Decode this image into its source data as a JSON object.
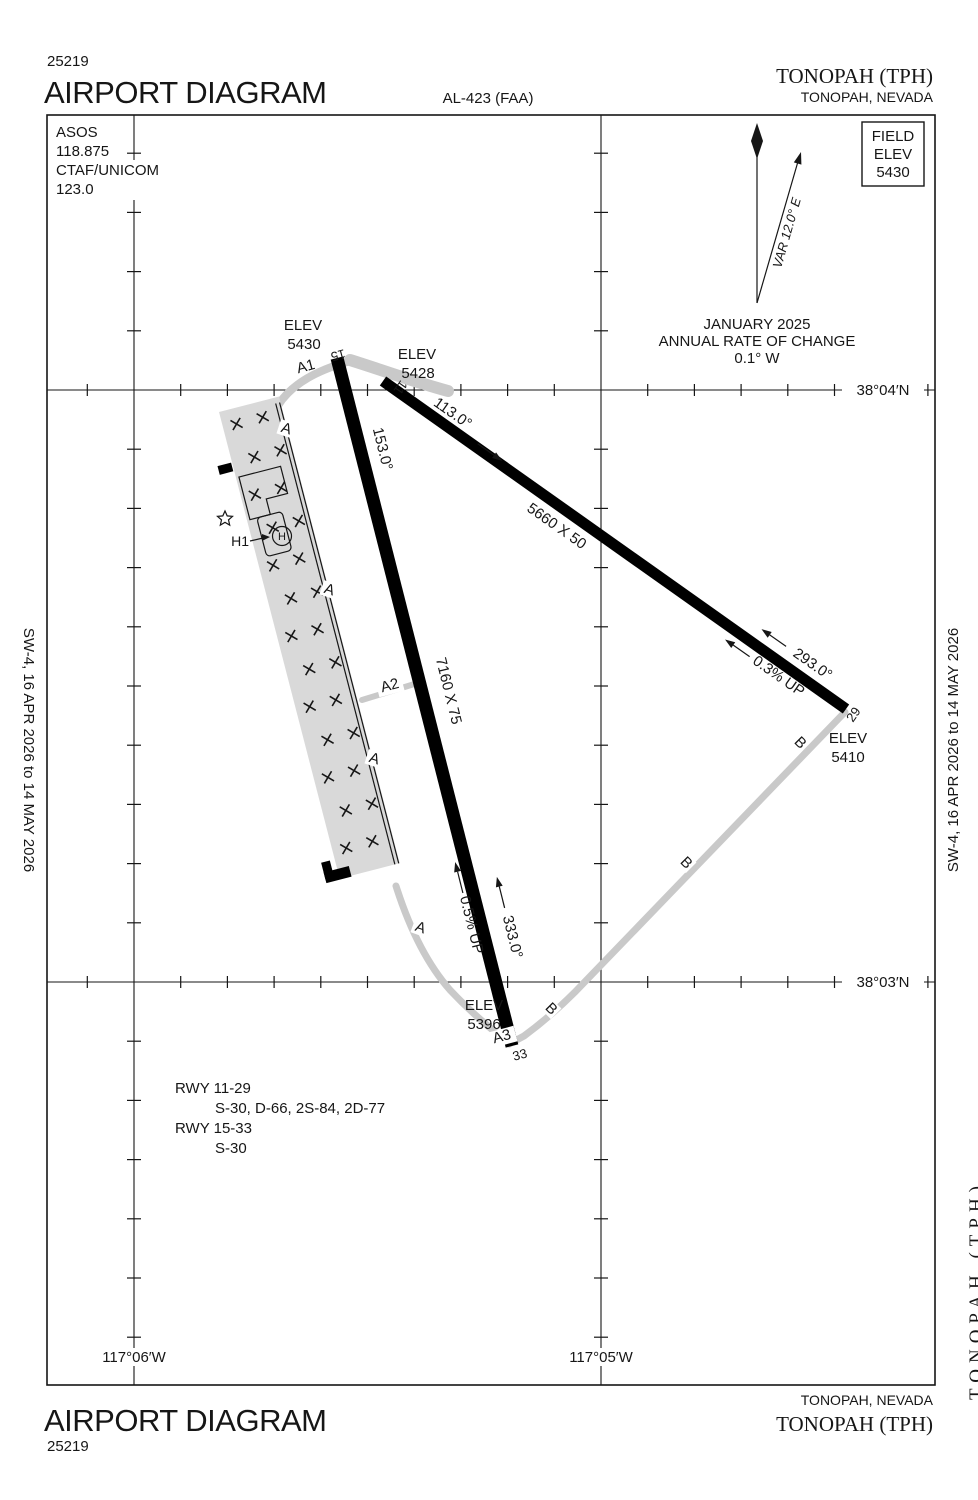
{
  "colors": {
    "runway": "#000000",
    "taxiway": "#c9c9c9",
    "apron": "#d9d9d9"
  },
  "header": {
    "chart_number": "25219",
    "title": "AIRPORT DIAGRAM",
    "al_number": "AL-423 (FAA)",
    "airport_name": "TONOPAH (TPH)",
    "city_state": "TONOPAH, NEVADA"
  },
  "comm": {
    "line1": "ASOS",
    "line2": "118.875",
    "line3": "CTAF/UNICOM",
    "line4": "123.0"
  },
  "field_elev_box": {
    "word1": "FIELD",
    "word2": "ELEV",
    "value": "5430"
  },
  "north": {
    "var": "VAR 12.0° E",
    "date": "JANUARY 2025",
    "rate_line1": "ANNUAL RATE OF CHANGE",
    "rate_line2": "0.1° W"
  },
  "grid_labels": {
    "lat_top": "38°04′N",
    "lat_bottom": "38°03′N",
    "lon_left": "117°06′W",
    "lon_right": "117°05′W"
  },
  "labels": {
    "elev": "ELEV"
  },
  "runway_15_33": {
    "num_15": "15",
    "num_33": "33",
    "heading_15": "153.0°",
    "heading_33": "333.0°",
    "dimensions": "7160 X 75",
    "slope": "0.5% UP",
    "elev_15": "5430",
    "elev_33": "5396"
  },
  "runway_11_29": {
    "num_11": "11",
    "num_29": "29",
    "heading_11": "113.0°",
    "heading_29": "293.0°",
    "dimensions": "5660 X 50",
    "slope": "0.3% UP",
    "elev_11": "5428",
    "elev_29": "5410"
  },
  "taxiways": {
    "a": "A",
    "a1": "A1",
    "a2": "A2",
    "a3": "A3",
    "b": "B",
    "h1": "H1",
    "helipad": "H"
  },
  "runway_data": {
    "line1": "RWY 11-29",
    "line2": "S-30, D-66, 2S-84, 2D-77",
    "line3": "RWY 15-33",
    "line4": "S-30"
  },
  "footer": {
    "title": "AIRPORT DIAGRAM",
    "chart_number": "25219",
    "city_state": "TONOPAH, NEVADA",
    "airport_name": "TONOPAH (TPH)"
  },
  "margins": {
    "side_text": "SW-4,  16 APR 2026  to  14 MAY 2026",
    "edge_text": "TONOPAH (TPH)"
  }
}
